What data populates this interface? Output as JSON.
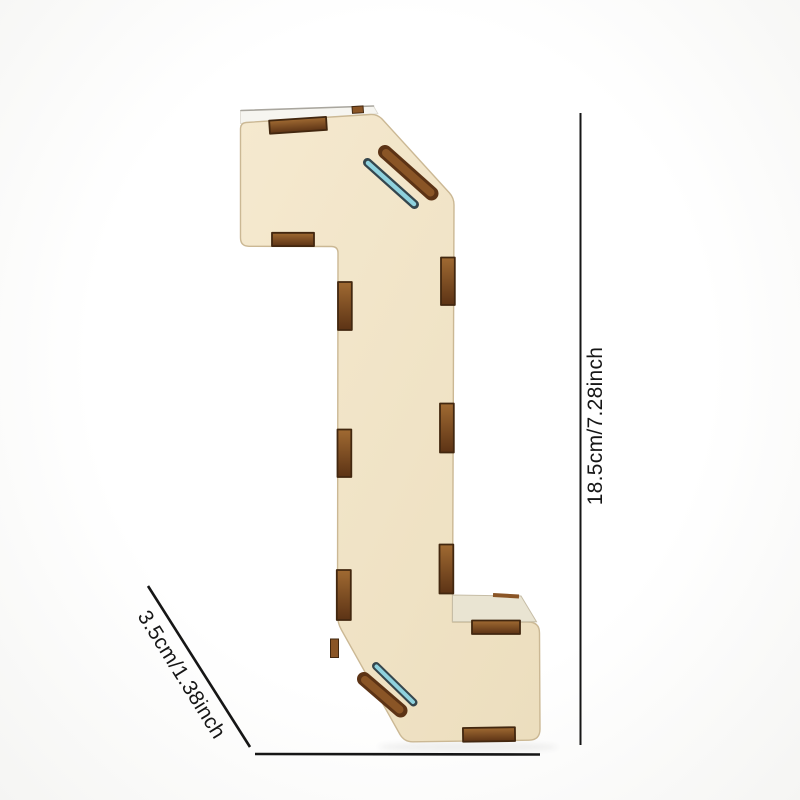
{
  "page": {
    "background": "#fdfdfc"
  },
  "product": {
    "semantic": "plywood-number-1-diy-kit-front-view",
    "numeral": "1"
  },
  "annotations": {
    "height_label": "18.5cm/7.28inch",
    "width_label": "3.5cm/1.38inch"
  },
  "colors": {
    "front_face_light": "#f5e9cf",
    "front_face_dark": "#ecdebe",
    "top_depth": "#f6f5f0",
    "base_top": "#e9e4d2",
    "slot_brown": "#8a5526",
    "slot_brown_light": "#a06a32",
    "slot_brown_deep": "#5c3315",
    "slot_outline": "#42270f",
    "acrylic_teal": "#8fd2de",
    "acrylic_teal_dark": "#35464d",
    "edge_line": "#a9a69e",
    "face_edge": "#cbb894",
    "dim_line": "#161616"
  }
}
